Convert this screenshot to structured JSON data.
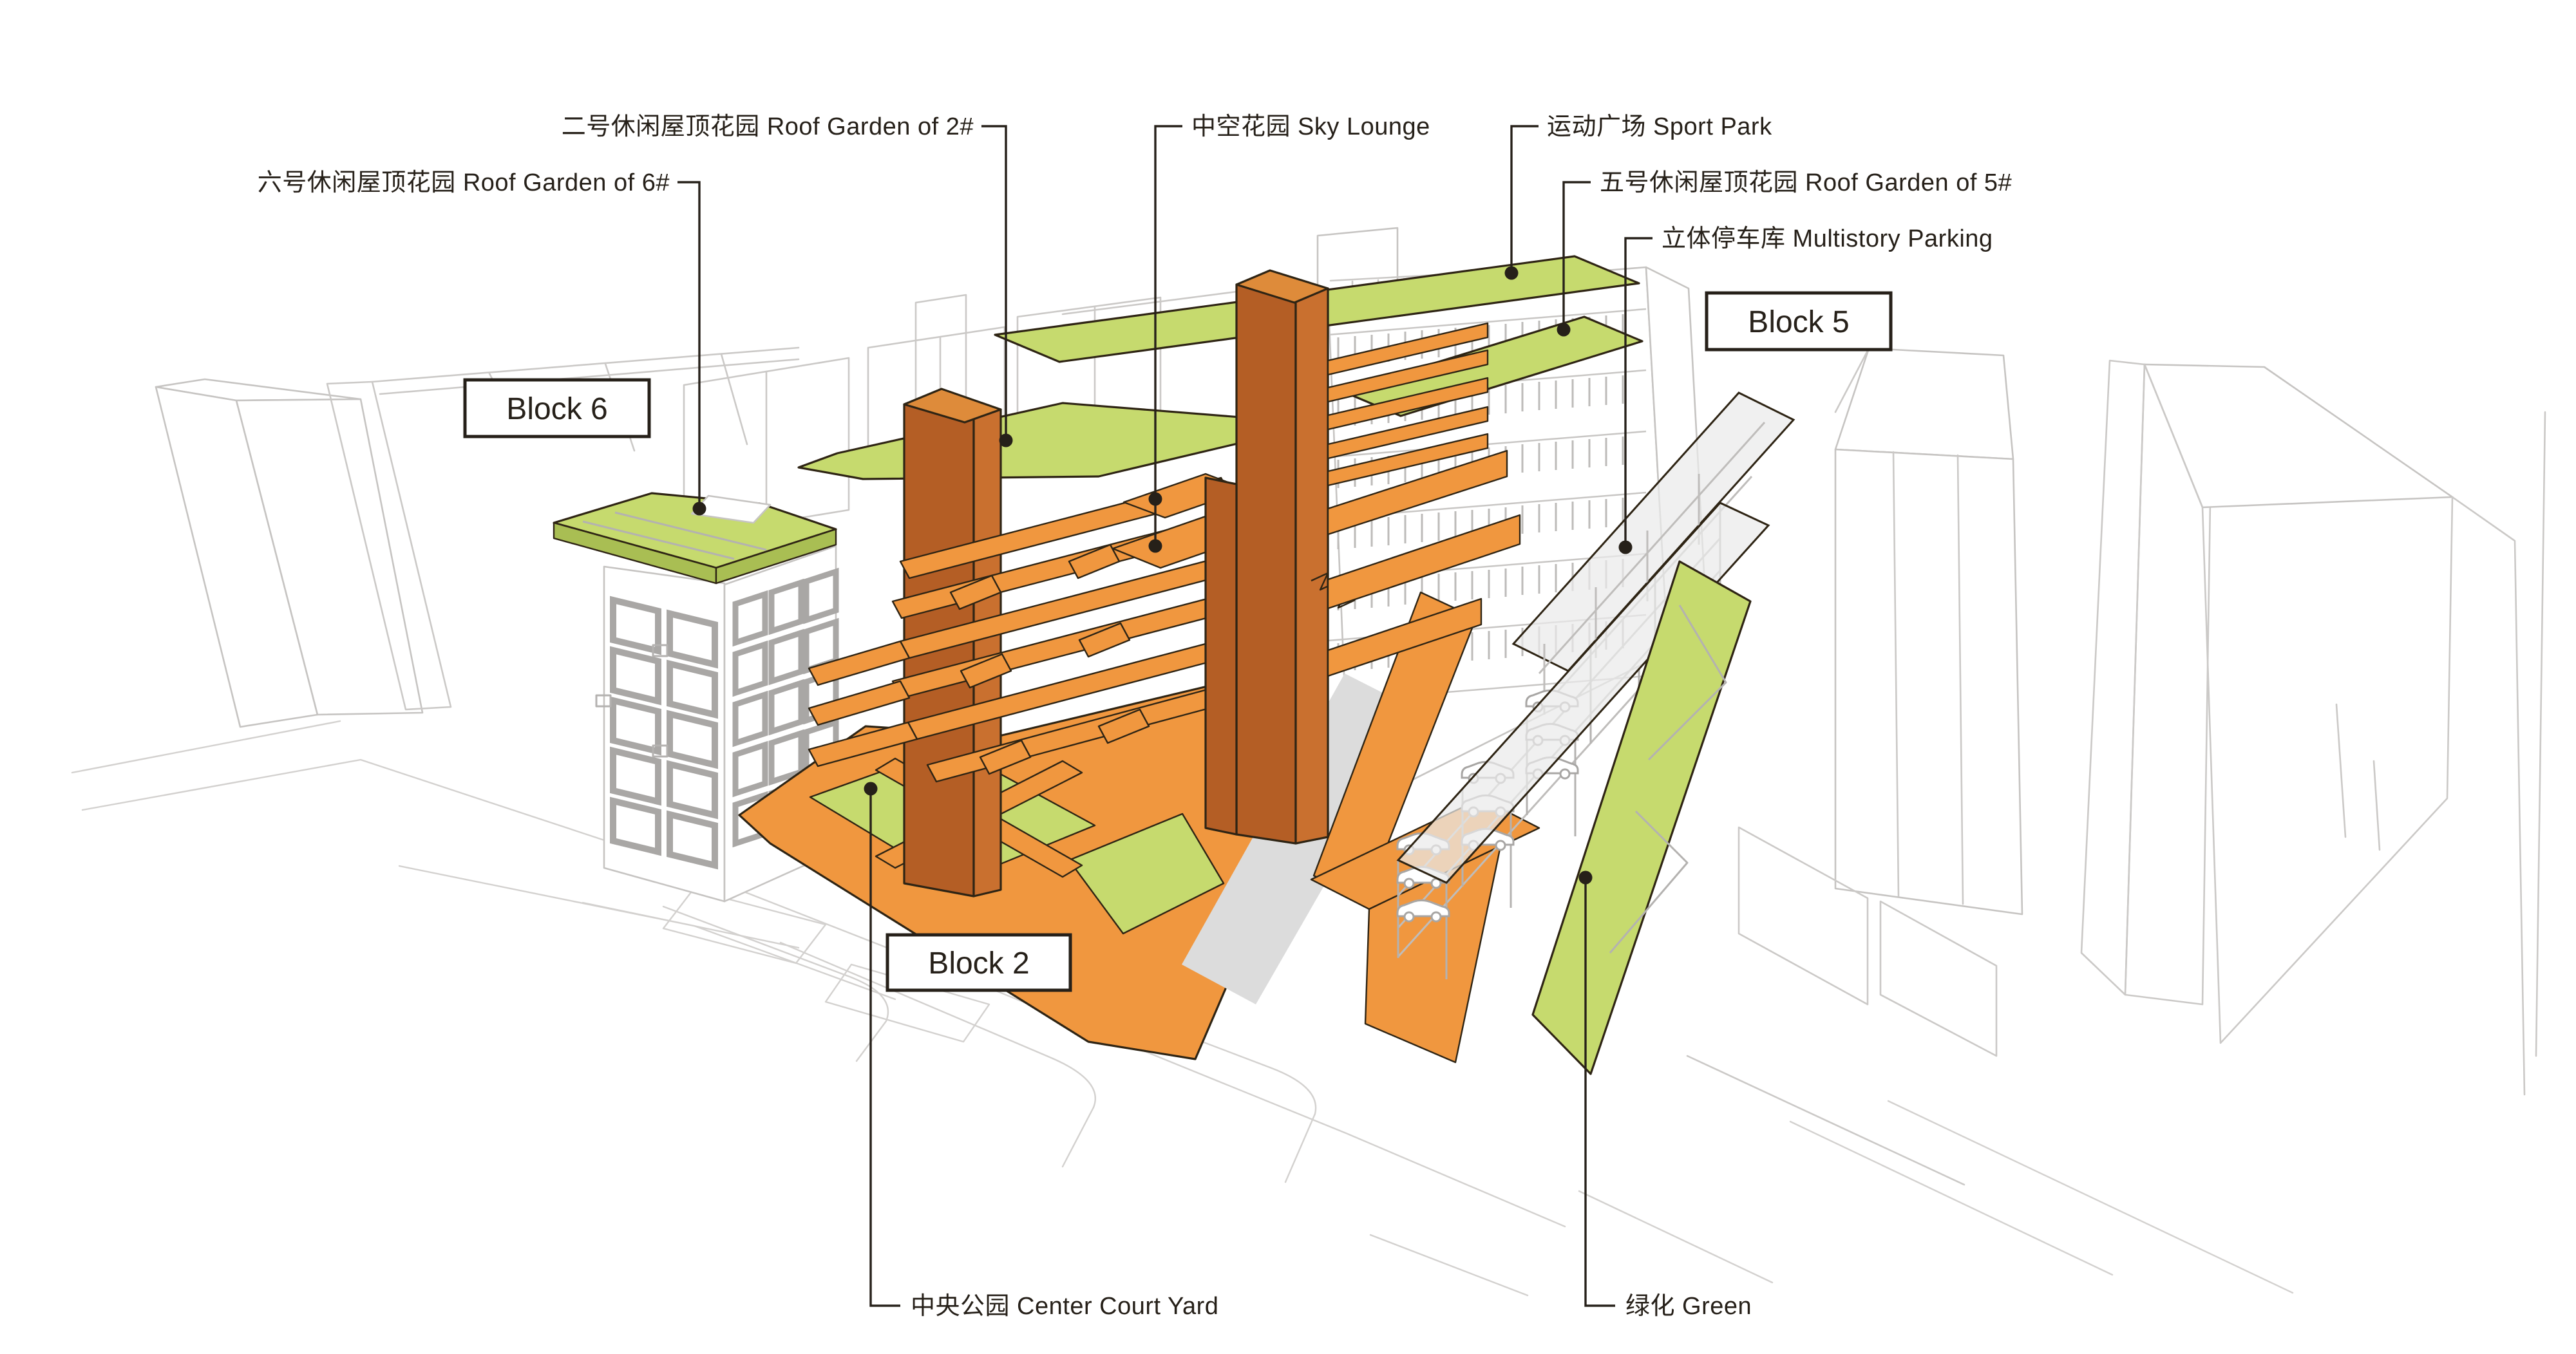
{
  "figure": {
    "type": "axonometric architecture concept diagram",
    "background": "#FFFFFF"
  },
  "palette": {
    "green": "#C6DA6E",
    "green_dark": "#A9BE53",
    "orange": "#F0973F",
    "orange_dark": "#D37E2D",
    "rust": "#B45E25",
    "rust_light": "#C9702F",
    "rust_cap": "#DE8B3A",
    "ink": "#262019"
  },
  "annotations": {
    "roof_garden_2": "二号休闲屋顶花园 Roof Garden of 2#",
    "sky_lounge": "中空花园 Sky Lounge",
    "sport_park": "运动广场 Sport Park",
    "roof_garden_6": "六号休闲屋顶花园 Roof Garden of 6#",
    "roof_garden_5": "五号休闲屋顶花园 Roof Garden of 5#",
    "multistory_parking": "立体停车库 Multistory Parking",
    "center_court_yard": "中央公园 Center Court Yard",
    "green": "绿化 Green"
  },
  "block_tags": {
    "block6": "Block 6",
    "block5": "Block 5",
    "block2": "Block 2"
  }
}
